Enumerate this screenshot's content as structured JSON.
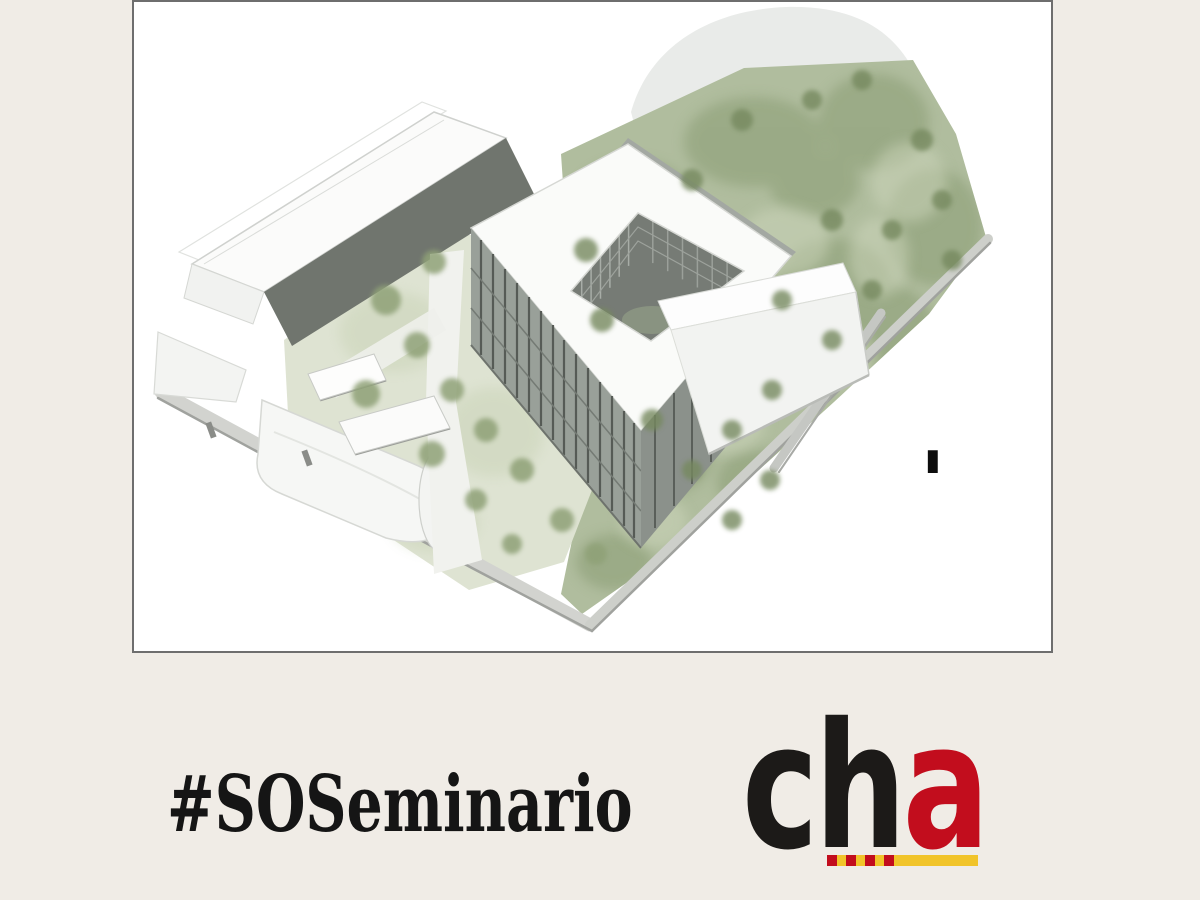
{
  "page": {
    "background": "#f0ece6",
    "frame_border": "#6e6e6e"
  },
  "artwork": {
    "description": "isometric-architectural-site-rendering",
    "label_mark": "I",
    "forest_green": "#aab497",
    "meadow_green": "#dee3d2",
    "building_white": "#fafbf9",
    "facade_dark_gray": "#70756e"
  },
  "hashtag": {
    "text": "#SOSeminario",
    "color": "#151515"
  },
  "logo": {
    "black_letters": "ch",
    "red_letter": "a",
    "black": "#1c1a18",
    "red": "#c20d1d",
    "yellow": "#f1c42a"
  }
}
